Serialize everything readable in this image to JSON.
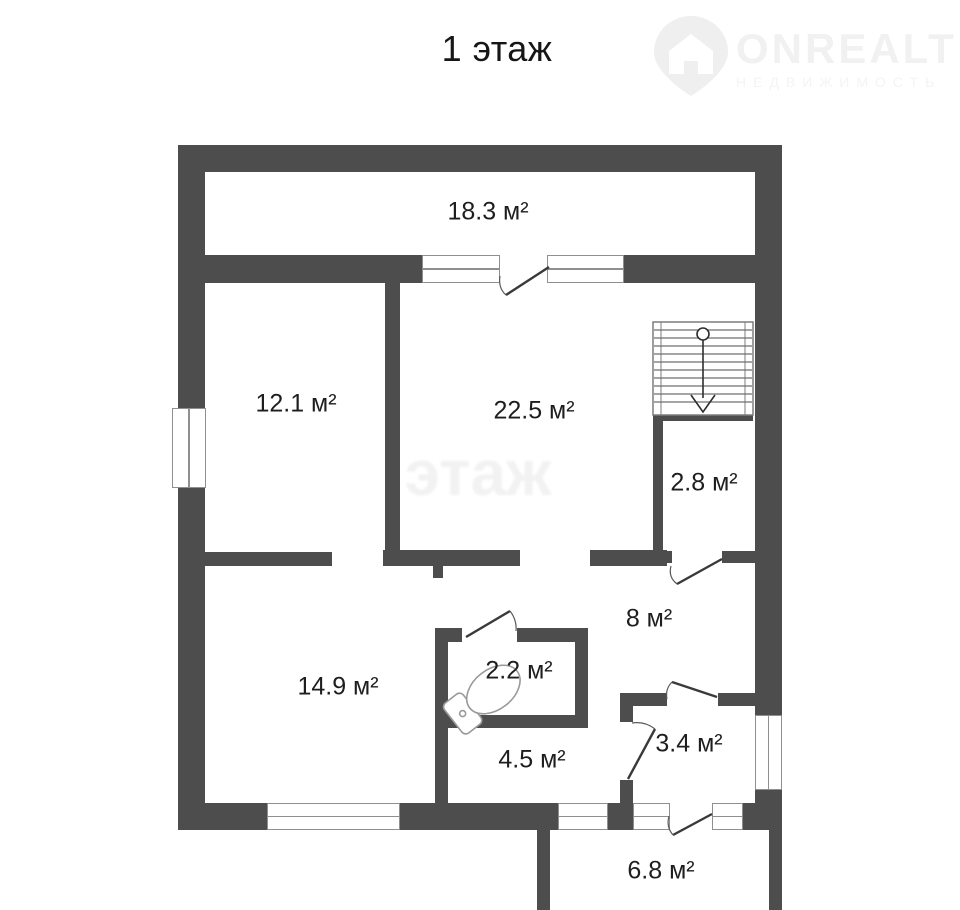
{
  "title": "1 этаж",
  "logo": {
    "brand": "ONREALT",
    "tagline": "НЕДВИЖИМОСТЬ"
  },
  "watermark": "этаж",
  "colors": {
    "wall": "#4d4d4d",
    "text": "#1e1e1e",
    "window_frame": "#8f8f8f",
    "door": "#3a3a3a",
    "arc": "#5a5a5a",
    "fixture": "#9a9a9a",
    "faint": "#f1f1f1"
  },
  "rooms": [
    {
      "name": "veranda",
      "area": "18.3 м²"
    },
    {
      "name": "room-12",
      "area": "12.1 м²"
    },
    {
      "name": "room-22",
      "area": "22.5 м²"
    },
    {
      "name": "closet-28",
      "area": "2.8 м²"
    },
    {
      "name": "hall-8",
      "area": "8 м²"
    },
    {
      "name": "room-14",
      "area": "14.9 м²"
    },
    {
      "name": "wc-22",
      "area": "2.2 м²"
    },
    {
      "name": "room-45",
      "area": "4.5 м²"
    },
    {
      "name": "lobby-34",
      "area": "3.4 м²"
    },
    {
      "name": "porch-68",
      "area": "6.8 м²"
    }
  ]
}
